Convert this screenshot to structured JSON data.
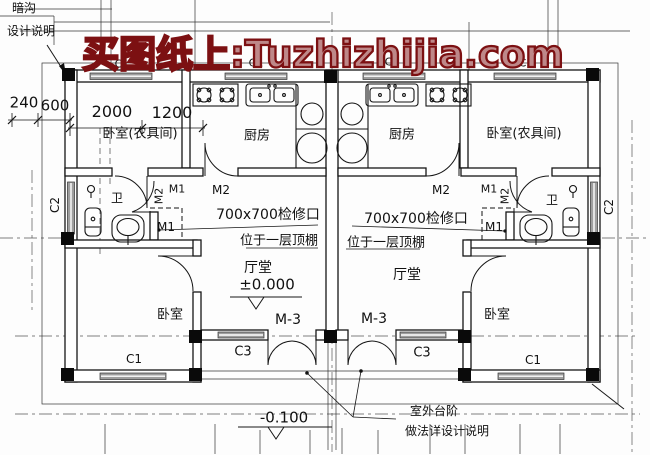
{
  "watermark": {
    "text": "买图纸上:Tuzhizhijia.com",
    "color": "#7c1012"
  },
  "plan": {
    "type": "floor-plan",
    "rooms": [
      "卧室(农具间)",
      "厨房",
      "卫",
      "厅堂",
      "卧室"
    ],
    "door_tags": [
      "M1",
      "M2",
      "M-3"
    ],
    "window_tags": [
      "C1",
      "C2",
      "C3"
    ],
    "levels": {
      "indoor": "±0.000",
      "outdoor": "-0.100"
    },
    "dimensions_mm": [
      "240",
      "600",
      "2000",
      "1200"
    ]
  },
  "annotations": [
    {
      "name": "note-gutter",
      "text": "暗沟",
      "x": 24,
      "y": 8,
      "fs": 12
    },
    {
      "name": "note-design-ref",
      "text": "设计说明",
      "x": 31,
      "y": 31,
      "fs": 12
    },
    {
      "name": "dim-240",
      "text": "240",
      "x": 24,
      "y": 103,
      "fs": 15
    },
    {
      "name": "dim-600",
      "text": "600",
      "x": 55,
      "y": 106,
      "fs": 15
    },
    {
      "name": "dim-2000",
      "text": "2000",
      "x": 112,
      "y": 112,
      "fs": 16
    },
    {
      "name": "dim-1200",
      "text": "1200",
      "x": 172,
      "y": 113,
      "fs": 16
    },
    {
      "name": "tag-c1-top-1",
      "text": "C1",
      "x": 122,
      "y": 64,
      "fs": 11
    },
    {
      "name": "tag-c1-top-2",
      "text": "C1",
      "x": 256,
      "y": 63,
      "fs": 11
    },
    {
      "name": "tag-c1-top-3",
      "text": "C1",
      "x": 392,
      "y": 62,
      "fs": 11
    },
    {
      "name": "tag-c1-top-4",
      "text": "C1",
      "x": 526,
      "y": 63,
      "fs": 11
    },
    {
      "name": "room-bedroom-tool-left",
      "text": "卧室(农具间)",
      "x": 140,
      "y": 134,
      "fs": 13
    },
    {
      "name": "room-kitchen-left",
      "text": "厨房",
      "x": 257,
      "y": 136,
      "fs": 13
    },
    {
      "name": "room-kitchen-right",
      "text": "厨房",
      "x": 402,
      "y": 135,
      "fs": 13
    },
    {
      "name": "room-bedroom-tool-right",
      "text": "卧室(农具间)",
      "x": 524,
      "y": 134,
      "fs": 13
    },
    {
      "name": "tag-c2-left",
      "text": "C2",
      "x": 55,
      "y": 205,
      "fs": 12,
      "rot": -90
    },
    {
      "name": "tag-c2-right",
      "text": "C2",
      "x": 609,
      "y": 207,
      "fs": 12,
      "rot": -90
    },
    {
      "name": "room-bath-left",
      "text": "卫",
      "x": 117,
      "y": 198,
      "fs": 12
    },
    {
      "name": "room-bath-right",
      "text": "卫",
      "x": 552,
      "y": 200,
      "fs": 12
    },
    {
      "name": "tag-m2-left-rot",
      "text": "M2",
      "x": 159,
      "y": 196,
      "fs": 11,
      "rot": -90
    },
    {
      "name": "tag-m1-left",
      "text": "M1",
      "x": 177,
      "y": 189,
      "fs": 11
    },
    {
      "name": "tag-m2-left",
      "text": "M2",
      "x": 221,
      "y": 190,
      "fs": 12
    },
    {
      "name": "tag-m2-right",
      "text": "M2",
      "x": 441,
      "y": 190,
      "fs": 12
    },
    {
      "name": "tag-m1-right",
      "text": "M1",
      "x": 489,
      "y": 189,
      "fs": 11
    },
    {
      "name": "tag-m2-right-rot",
      "text": "M2",
      "x": 505,
      "y": 196,
      "fs": 11,
      "rot": -90
    },
    {
      "name": "tag-m1-hatch-left",
      "text": "M1",
      "x": 166,
      "y": 227,
      "fs": 12
    },
    {
      "name": "tag-m1-hatch-right",
      "text": "M1",
      "x": 494,
      "y": 227,
      "fs": 12
    },
    {
      "name": "note-hatch-left",
      "text": "700x700检修口",
      "x": 268,
      "y": 215,
      "fs": 14
    },
    {
      "name": "note-hatch-right",
      "text": "700x700检修口",
      "x": 416,
      "y": 219,
      "fs": 14
    },
    {
      "name": "note-hatch2-left",
      "text": "位于一层顶棚",
      "x": 279,
      "y": 241,
      "fs": 13
    },
    {
      "name": "note-hatch2-right",
      "text": "位于一层顶棚",
      "x": 386,
      "y": 243,
      "fs": 13
    },
    {
      "name": "room-hall-left",
      "text": "厅堂",
      "x": 258,
      "y": 268,
      "fs": 14
    },
    {
      "name": "room-hall-right",
      "text": "厅堂",
      "x": 407,
      "y": 275,
      "fs": 14
    },
    {
      "name": "level-indoor",
      "text": "±0.000",
      "x": 267,
      "y": 285,
      "fs": 15
    },
    {
      "name": "room-bedroom-left",
      "text": "卧室",
      "x": 170,
      "y": 315,
      "fs": 13
    },
    {
      "name": "room-bedroom-right",
      "text": "卧室",
      "x": 497,
      "y": 315,
      "fs": 13
    },
    {
      "name": "tag-m3-left",
      "text": "M-3",
      "x": 288,
      "y": 320,
      "fs": 14
    },
    {
      "name": "tag-m3-right",
      "text": "M-3",
      "x": 374,
      "y": 319,
      "fs": 14
    },
    {
      "name": "tag-c3-left",
      "text": "C3",
      "x": 243,
      "y": 352,
      "fs": 13
    },
    {
      "name": "tag-c3-right",
      "text": "C3",
      "x": 422,
      "y": 353,
      "fs": 13
    },
    {
      "name": "tag-c1-bottom-left",
      "text": "C1",
      "x": 134,
      "y": 359,
      "fs": 12
    },
    {
      "name": "tag-c1-bottom-right",
      "text": "C1",
      "x": 533,
      "y": 360,
      "fs": 12
    },
    {
      "name": "level-outdoor",
      "text": "-0.100",
      "x": 284,
      "y": 418,
      "fs": 15
    },
    {
      "name": "note-steps-1",
      "text": "室外台阶",
      "x": 434,
      "y": 411,
      "fs": 12
    },
    {
      "name": "note-steps-2",
      "text": "做法详设计说明",
      "x": 447,
      "y": 431,
      "fs": 12
    }
  ]
}
